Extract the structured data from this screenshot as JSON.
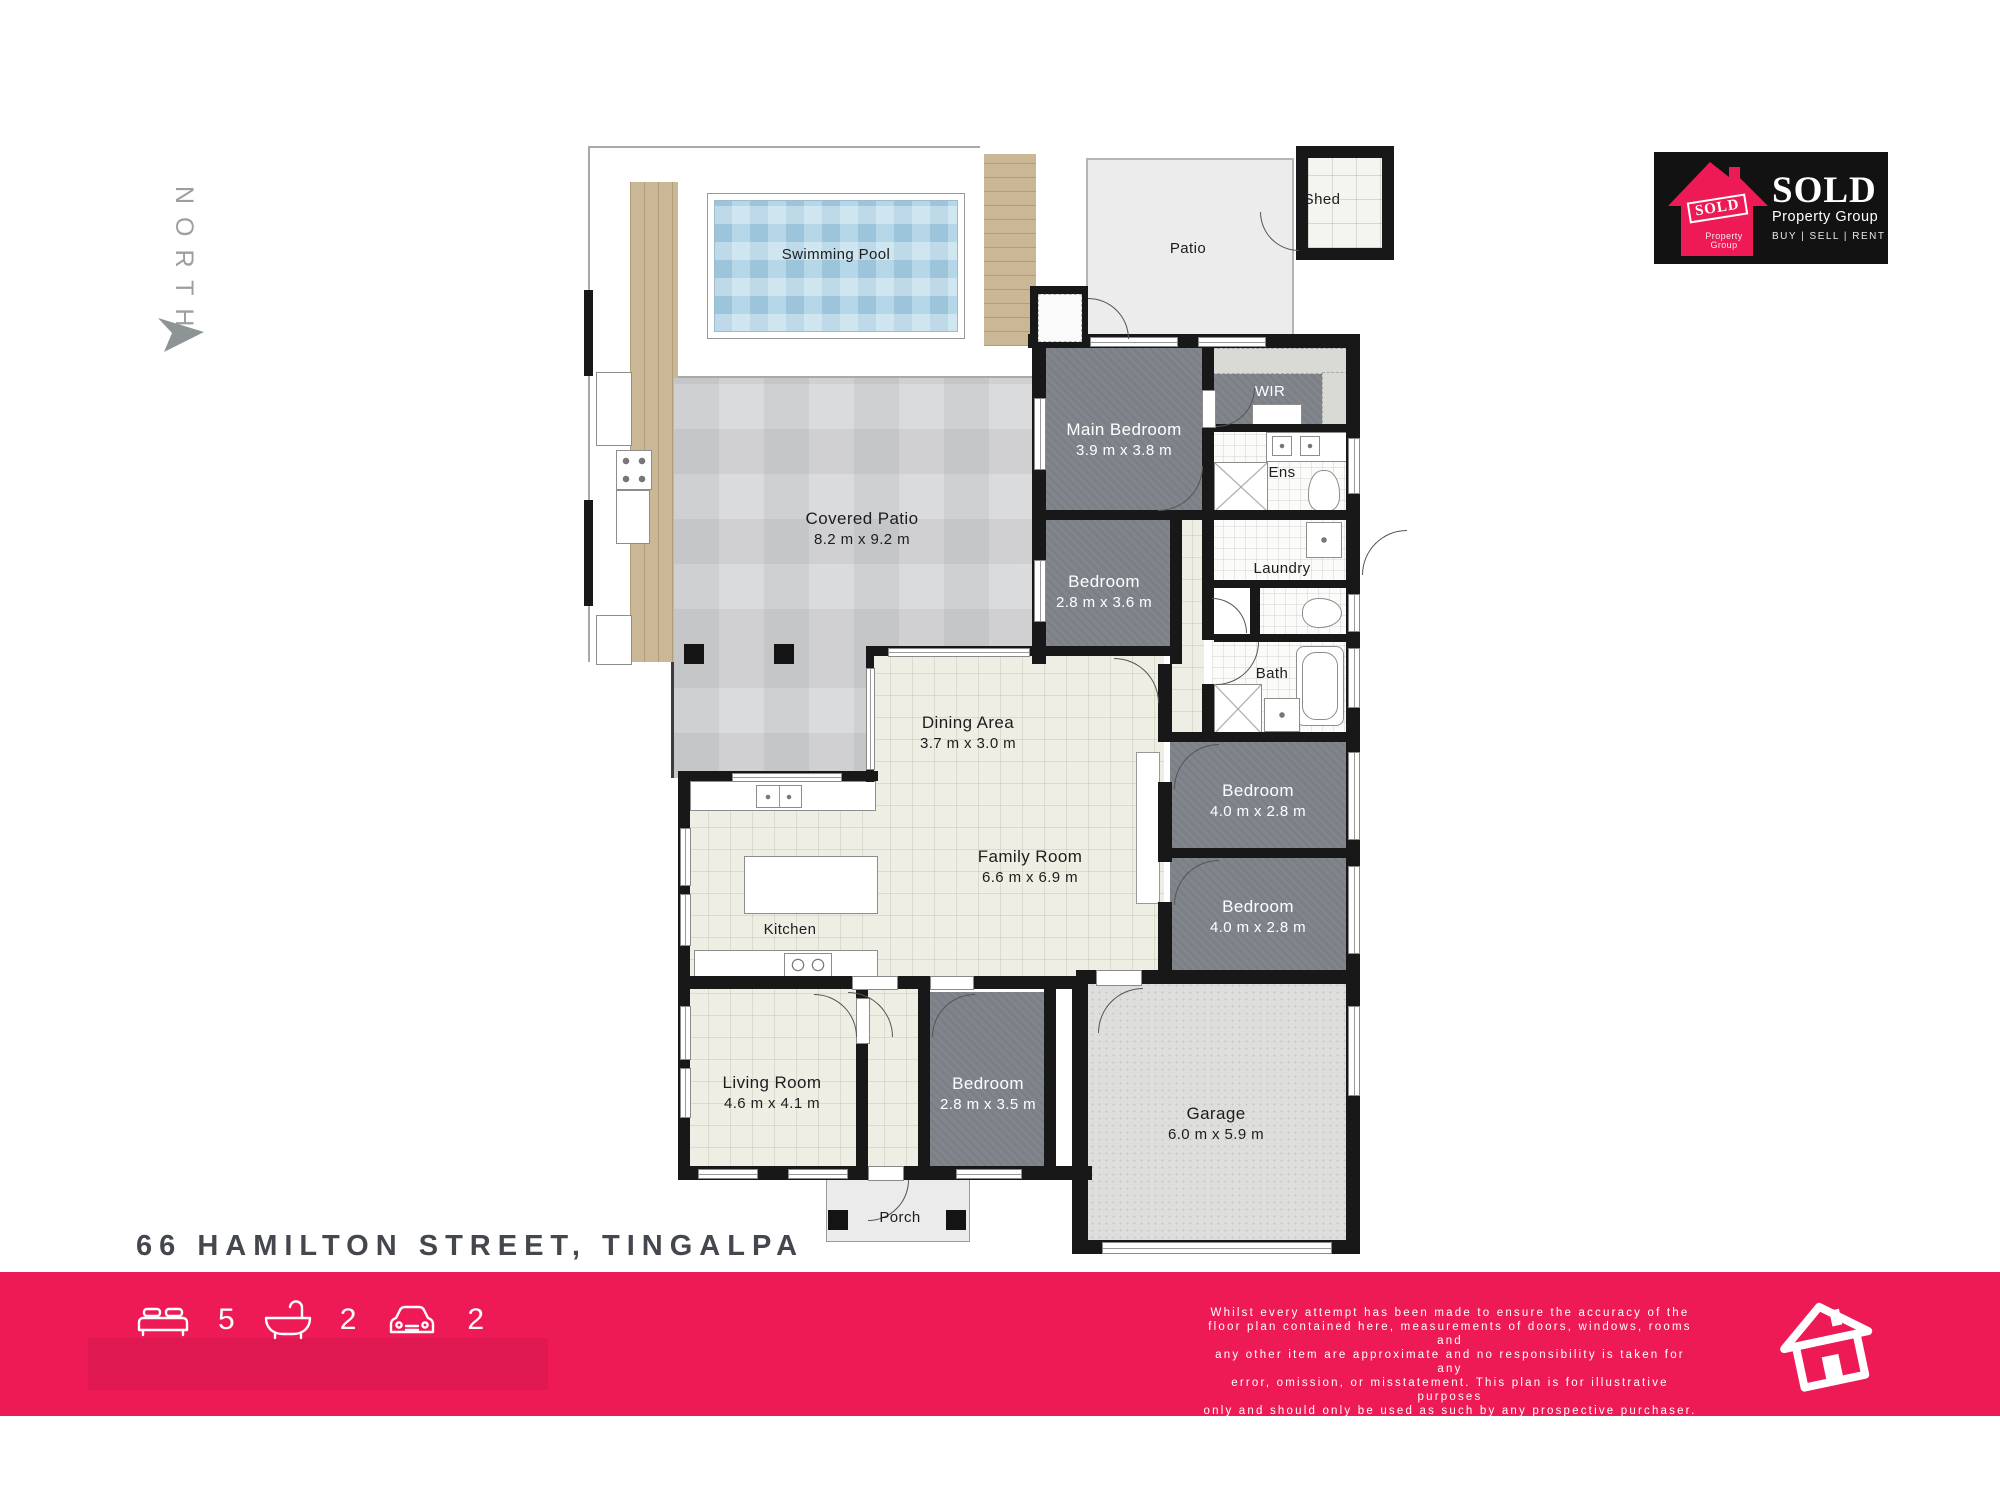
{
  "north_label": "NORTH",
  "address": "66 HAMILTON STREET, TINGALPA",
  "colors": {
    "accent": "#ed1a56",
    "wall": "#181818",
    "dark_room": "#7b8086"
  },
  "logo": {
    "stamp": "SOLD",
    "stamp_sub": "Property Group",
    "name": "SOLD",
    "name_sub": "Property Group",
    "tagline": "BUY  |  SELL  |  RENT"
  },
  "stats": {
    "beds": "5",
    "baths": "2",
    "cars": "2"
  },
  "icons": [
    "bed-icon",
    "bath-icon",
    "car-icon",
    "house-icon",
    "north-arrow-icon"
  ],
  "disclaimer": "Whilst every attempt has been made to ensure the accuracy of the\nfloor plan contained here, measurements of doors, windows, rooms and\nany other item are approximate and no responsibility is taken for any\nerror, omission, or misstatement. This plan is for illustrative purposes\nonly and should only be used as such by any prospective purchaser.",
  "rooms": {
    "swimming_pool": {
      "name": "Swimming Pool"
    },
    "patio": {
      "name": "Patio"
    },
    "shed": {
      "name": "Shed"
    },
    "main_bedroom": {
      "name": "Main Bedroom",
      "dims": "3.9 m x 3.8 m"
    },
    "wir": {
      "name": "WIR"
    },
    "ens": {
      "name": "Ens"
    },
    "laundry": {
      "name": "Laundry"
    },
    "bedroom_mid": {
      "name": "Bedroom",
      "dims": "2.8 m x 3.6 m"
    },
    "bath": {
      "name": "Bath"
    },
    "covered_patio": {
      "name": "Covered Patio",
      "dims": "8.2 m x 9.2 m"
    },
    "dining": {
      "name": "Dining Area",
      "dims": "3.7 m x 3.0 m"
    },
    "family": {
      "name": "Family Room",
      "dims": "6.6 m x 6.9 m"
    },
    "kitchen": {
      "name": "Kitchen"
    },
    "bedroom_e1": {
      "name": "Bedroom",
      "dims": "4.0 m x 2.8 m"
    },
    "bedroom_e2": {
      "name": "Bedroom",
      "dims": "4.0 m x 2.8 m"
    },
    "living": {
      "name": "Living Room",
      "dims": "4.6 m x 4.1 m"
    },
    "bedroom_s": {
      "name": "Bedroom",
      "dims": "2.8 m x 3.5 m"
    },
    "garage": {
      "name": "Garage",
      "dims": "6.0 m x 5.9 m"
    },
    "porch": {
      "name": "Porch"
    }
  }
}
